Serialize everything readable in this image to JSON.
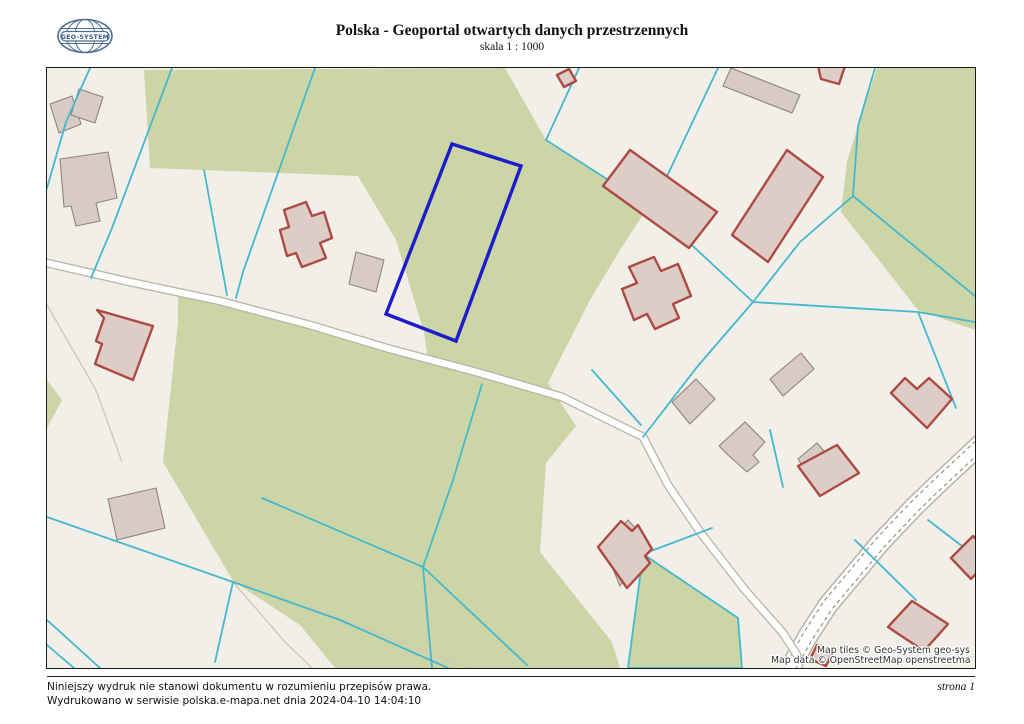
{
  "header": {
    "title": "Polska - Geoportal otwartych danych przestrzennych",
    "scale_label": "skala 1 : 1000",
    "logo_text": "GEO-SYSTEM"
  },
  "map": {
    "attribution_line1": "Map tiles © Geo-System geo-sys",
    "attribution_line2": "Map data © OpenStreetMap openstreetma",
    "colors": {
      "background": "#f2efe9",
      "green_area": "#ccd5a5",
      "parcel_line": "#45b8ce",
      "building_fill": "#d8cbc5",
      "building_stroke": "#8f8479",
      "registry_fill": "#ddcdc6",
      "registry_stroke": "#ae4a45",
      "highlight": "#1c1ccd",
      "road_fill": "#ffffff",
      "road_casing": "#b9b3a6",
      "road_dash": "#8f897c",
      "path_line": "#cfc8bb"
    }
  },
  "footer": {
    "disclaimer": "Niniejszy wydruk nie stanowi dokumentu w rozumieniu przepisów prawa.",
    "printed_info": "Wydrukowano w serwisie polska.e-mapa.net dnia 2024-04-10 14:04:10",
    "page_label": "strona 1"
  }
}
